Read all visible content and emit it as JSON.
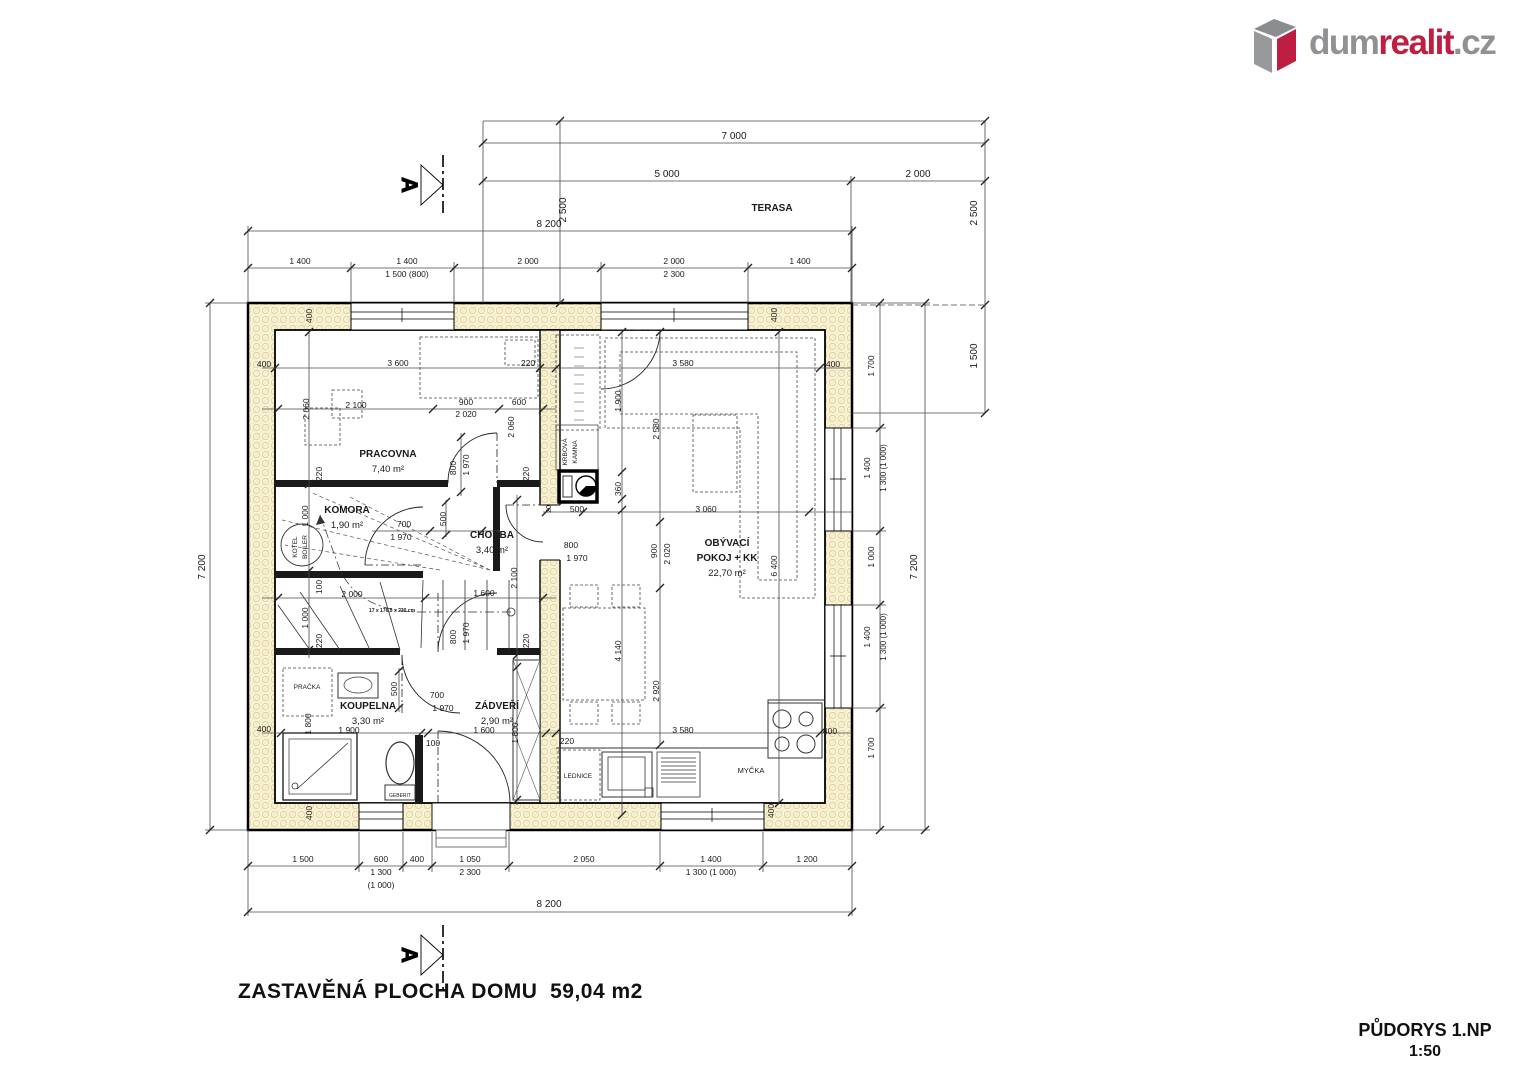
{
  "logo": {
    "icon": "house-box-icon",
    "part1": "dum",
    "part2": "realit",
    "part3": ".cz",
    "color_gray": "#8f9193",
    "color_red": "#be1e41"
  },
  "drawing": {
    "title": "PŮDORYS 1.NP",
    "scale": "1:50",
    "built_area_note": "ZASTAVĚNÁ PLOCHA DOMU  59,04 m2",
    "section_label": "A",
    "watermark": "dumrealit.cz"
  },
  "rooms": [
    {
      "name": "PRACOVNA",
      "area": "7,40 m²",
      "x": 388,
      "y": 457
    },
    {
      "name": "KOMORA",
      "area": "1,90 m²",
      "x": 347,
      "y": 513
    },
    {
      "name": "CHODBA",
      "area": "3,40 m²",
      "x": 492,
      "y": 538
    },
    {
      "name": "KOUPELNA",
      "area": "3,30 m²",
      "x": 368,
      "y": 709
    },
    {
      "name": "ZÁDVEŘÍ",
      "area": "2,90 m²",
      "x": 497,
      "y": 709
    },
    {
      "name": "OBÝVACÍ",
      "area": "",
      "x": 727,
      "y": 546
    },
    {
      "name": "POKOJ + KK",
      "area": "22,70 m²",
      "x": 727,
      "y": 561
    },
    {
      "name": "TERASA",
      "area": "",
      "x": 772,
      "y": 211
    }
  ],
  "plan_labels": [
    {
      "t": "7 000",
      "x": 734,
      "y": 139,
      "s": 10
    },
    {
      "t": "5 000",
      "x": 667,
      "y": 177,
      "s": 10
    },
    {
      "t": "2 000",
      "x": 918,
      "y": 177,
      "s": 10
    },
    {
      "t": "8 200",
      "x": 549,
      "y": 227,
      "s": 10
    },
    {
      "t": "2 500",
      "x": 566,
      "y": 210,
      "r": -90,
      "s": 10
    },
    {
      "t": "2 500",
      "x": 977,
      "y": 213,
      "r": -90,
      "s": 10
    },
    {
      "t": "1 500",
      "x": 977,
      "y": 356,
      "r": -90,
      "s": 10
    },
    {
      "t": "1 400",
      "x": 300,
      "y": 264
    },
    {
      "t": "1 400",
      "x": 407,
      "y": 264
    },
    {
      "t": "1 500 (800)",
      "x": 407,
      "y": 277
    },
    {
      "t": "2 000",
      "x": 528,
      "y": 264
    },
    {
      "t": "2 000",
      "x": 674,
      "y": 264
    },
    {
      "t": "2 300",
      "x": 674,
      "y": 277
    },
    {
      "t": "1 400",
      "x": 800,
      "y": 264
    },
    {
      "t": "7 200",
      "x": 205,
      "y": 567,
      "r": -90,
      "s": 10
    },
    {
      "t": "7 200",
      "x": 917,
      "y": 567,
      "r": -90,
      "s": 10
    },
    {
      "t": "1 700",
      "x": 874,
      "y": 366,
      "r": -90
    },
    {
      "t": "1 400",
      "x": 870,
      "y": 468,
      "r": -90
    },
    {
      "t": "1 300 (1 000)",
      "x": 886,
      "y": 468,
      "r": -90,
      "s": 8
    },
    {
      "t": "1 000",
      "x": 874,
      "y": 557,
      "r": -90
    },
    {
      "t": "1 400",
      "x": 870,
      "y": 637,
      "r": -90
    },
    {
      "t": "1 300 (1 000)",
      "x": 886,
      "y": 637,
      "r": -90,
      "s": 8
    },
    {
      "t": "1 700",
      "x": 874,
      "y": 748,
      "r": -90
    },
    {
      "t": "1 500",
      "x": 303,
      "y": 862
    },
    {
      "t": "600",
      "x": 381,
      "y": 862
    },
    {
      "t": "1 300",
      "x": 381,
      "y": 875
    },
    {
      "t": "(1 000)",
      "x": 381,
      "y": 888
    },
    {
      "t": "400",
      "x": 417,
      "y": 862
    },
    {
      "t": "1 050",
      "x": 470,
      "y": 862
    },
    {
      "t": "2 300",
      "x": 470,
      "y": 875
    },
    {
      "t": "2 050",
      "x": 584,
      "y": 862
    },
    {
      "t": "1 400",
      "x": 711,
      "y": 862
    },
    {
      "t": "1 300 (1 000)",
      "x": 711,
      "y": 875
    },
    {
      "t": "1 200",
      "x": 807,
      "y": 862
    },
    {
      "t": "8 200",
      "x": 549,
      "y": 907,
      "s": 10
    },
    {
      "t": "400",
      "x": 312,
      "y": 316,
      "r": -90,
      "s": 8.5
    },
    {
      "t": "400",
      "x": 777,
      "y": 315,
      "r": -90,
      "s": 8.5
    },
    {
      "t": "400",
      "x": 264,
      "y": 367,
      "s": 8.5
    },
    {
      "t": "400",
      "x": 833,
      "y": 367,
      "s": 8.5
    },
    {
      "t": "400",
      "x": 264,
      "y": 732,
      "s": 8.5
    },
    {
      "t": "400",
      "x": 312,
      "y": 813,
      "r": -90,
      "s": 8.5
    },
    {
      "t": "400",
      "x": 774,
      "y": 811,
      "r": -90,
      "s": 8.5
    },
    {
      "t": "400",
      "x": 830,
      "y": 734,
      "s": 8.5
    },
    {
      "t": "3 600",
      "x": 398,
      "y": 366,
      "s": 8.5
    },
    {
      "t": "220",
      "x": 528,
      "y": 366,
      "s": 8.5
    },
    {
      "t": "2 100",
      "x": 356,
      "y": 408,
      "s": 8.5
    },
    {
      "t": "2 060",
      "x": 309,
      "y": 409,
      "r": -90,
      "s": 8.5
    },
    {
      "t": "900",
      "x": 466,
      "y": 405,
      "s": 8.5
    },
    {
      "t": "2 020",
      "x": 466,
      "y": 417,
      "s": 8.5
    },
    {
      "t": "600",
      "x": 519,
      "y": 405,
      "s": 8.5
    },
    {
      "t": "2 060",
      "x": 514,
      "y": 427,
      "r": -90,
      "s": 8.5
    },
    {
      "t": "800",
      "x": 456,
      "y": 468,
      "r": -90,
      "s": 8.5
    },
    {
      "t": "1 970",
      "x": 469,
      "y": 465,
      "r": -90,
      "s": 8.5
    },
    {
      "t": "220",
      "x": 322,
      "y": 474,
      "r": -90,
      "s": 8.5
    },
    {
      "t": "220",
      "x": 529,
      "y": 474,
      "r": -90,
      "s": 8.5
    },
    {
      "t": "1 000",
      "x": 308,
      "y": 516,
      "r": -90,
      "s": 8.5
    },
    {
      "t": "700",
      "x": 404,
      "y": 527,
      "s": 8.5
    },
    {
      "t": "1 970",
      "x": 401,
      "y": 540,
      "s": 8.5
    },
    {
      "t": "500",
      "x": 446,
      "y": 519,
      "r": -90,
      "s": 8.5
    },
    {
      "t": "100",
      "x": 322,
      "y": 587,
      "r": -90,
      "s": 8.5
    },
    {
      "t": "2 000",
      "x": 352,
      "y": 597,
      "s": 8.5
    },
    {
      "t": "1 000",
      "x": 308,
      "y": 618,
      "r": -90,
      "s": 8.5
    },
    {
      "t": "220",
      "x": 322,
      "y": 641,
      "r": -90,
      "s": 8.5
    },
    {
      "t": "17 x 176,5 x 230 cm",
      "x": 392,
      "y": 612,
      "s": 5,
      "b": true
    },
    {
      "t": "2 100",
      "x": 517,
      "y": 578,
      "r": -90,
      "s": 8.5
    },
    {
      "t": "1 600",
      "x": 484,
      "y": 596,
      "s": 8.5
    },
    {
      "t": "800",
      "x": 456,
      "y": 637,
      "r": -90,
      "s": 8.5
    },
    {
      "t": "1 970",
      "x": 469,
      "y": 633,
      "r": -90,
      "s": 8.5
    },
    {
      "t": "220",
      "x": 529,
      "y": 641,
      "r": -90,
      "s": 8.5
    },
    {
      "t": "20",
      "x": 551,
      "y": 509,
      "r": -90,
      "s": 7
    },
    {
      "t": "500",
      "x": 577,
      "y": 512,
      "s": 8.5
    },
    {
      "t": "800",
      "x": 571,
      "y": 548,
      "s": 8.5
    },
    {
      "t": "1 970",
      "x": 577,
      "y": 561,
      "s": 8.5
    },
    {
      "t": "500",
      "x": 397,
      "y": 689,
      "r": -90,
      "s": 8.5
    },
    {
      "t": "700",
      "x": 437,
      "y": 698,
      "s": 8.5
    },
    {
      "t": "1 970",
      "x": 443,
      "y": 711,
      "s": 8.5
    },
    {
      "t": "1 800",
      "x": 311,
      "y": 724,
      "r": -90,
      "s": 8.5
    },
    {
      "t": "1 900",
      "x": 349,
      "y": 733,
      "s": 8.5
    },
    {
      "t": "1 600",
      "x": 484,
      "y": 733,
      "s": 8.5
    },
    {
      "t": "100",
      "x": 433,
      "y": 746,
      "s": 8.5
    },
    {
      "t": "1 800",
      "x": 518,
      "y": 733,
      "r": -90,
      "s": 8.5
    },
    {
      "t": "220",
      "x": 567,
      "y": 744,
      "s": 8.5
    },
    {
      "t": "PRAČKA",
      "x": 307,
      "y": 689,
      "s": 6.5,
      "n": "washer-label"
    },
    {
      "t": "GEBERIT",
      "x": 400,
      "y": 797,
      "s": 5,
      "n": "toilet-label"
    },
    {
      "t": "KOTEL",
      "x": 297,
      "y": 547,
      "r": -90,
      "s": 6.5,
      "n": "boiler-label"
    },
    {
      "t": "BOILER",
      "x": 307,
      "y": 547,
      "r": -90,
      "s": 6.5,
      "n": "boiler-label"
    },
    {
      "t": "3 580",
      "x": 683,
      "y": 366,
      "s": 8.5
    },
    {
      "t": "1 900",
      "x": 621,
      "y": 401,
      "r": -90,
      "s": 8.5
    },
    {
      "t": "2 580",
      "x": 659,
      "y": 429,
      "r": -90,
      "s": 8.5
    },
    {
      "t": "360",
      "x": 621,
      "y": 489,
      "r": -90,
      "s": 8.5
    },
    {
      "t": "3 060",
      "x": 706,
      "y": 512,
      "s": 8.5
    },
    {
      "t": "900",
      "x": 657,
      "y": 551,
      "r": -90,
      "s": 8.5
    },
    {
      "t": "2 020",
      "x": 670,
      "y": 554,
      "r": -90,
      "s": 8.5
    },
    {
      "t": "6 400",
      "x": 777,
      "y": 566,
      "r": -90,
      "s": 8.5
    },
    {
      "t": "4 140",
      "x": 621,
      "y": 651,
      "r": -90,
      "s": 8.5
    },
    {
      "t": "2 920",
      "x": 659,
      "y": 691,
      "r": -90,
      "s": 8.5
    },
    {
      "t": "3 580",
      "x": 683,
      "y": 733,
      "s": 8.5
    },
    {
      "t": "KRBOVÁ",
      "x": 567,
      "y": 452,
      "r": -90,
      "s": 6.5,
      "n": "fireplace-label"
    },
    {
      "t": "KAMNA",
      "x": 577,
      "y": 452,
      "r": -90,
      "s": 6.5,
      "n": "fireplace-label"
    },
    {
      "t": "LEDNICE",
      "x": 578,
      "y": 778,
      "s": 6.5,
      "n": "fridge-label"
    },
    {
      "t": "MYČKA",
      "x": 751,
      "y": 773,
      "s": 7.5,
      "n": "dishwasher-label"
    }
  ]
}
